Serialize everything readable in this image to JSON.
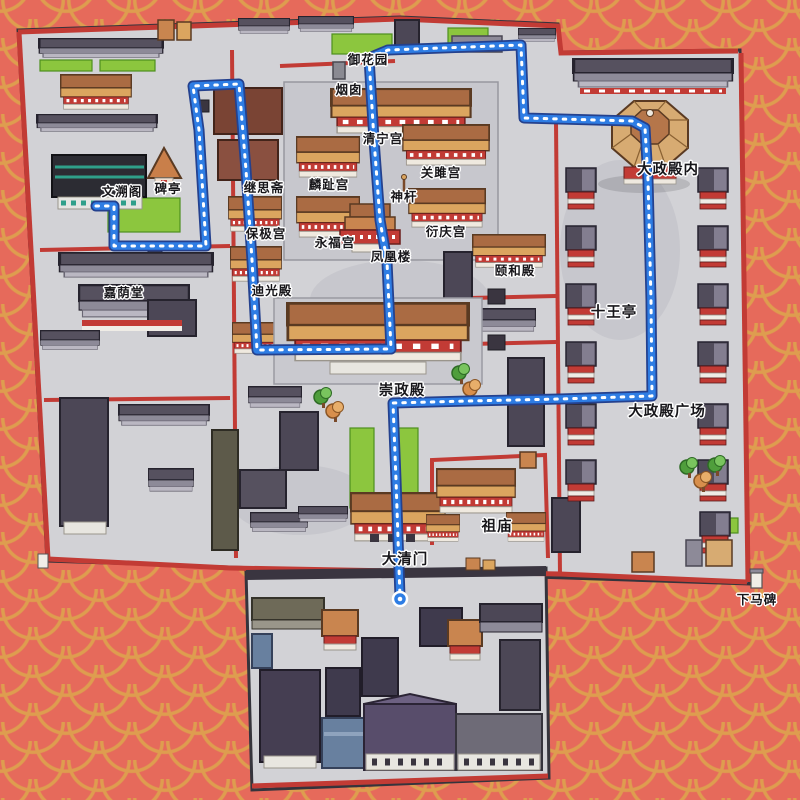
{
  "labels": [
    {
      "id": "yuhuayuan",
      "text": "御花园"
    },
    {
      "id": "yancong",
      "text": "烟囱"
    },
    {
      "id": "qingninggong",
      "text": "清宁宫"
    },
    {
      "id": "guanjugong",
      "text": "关雎宫"
    },
    {
      "id": "linzhigong",
      "text": "麟趾宫"
    },
    {
      "id": "shengan",
      "text": "神杆"
    },
    {
      "id": "yanqinggong",
      "text": "衍庆宫"
    },
    {
      "id": "yongfugong",
      "text": "永福宫"
    },
    {
      "id": "fenghuanglou",
      "text": "凤凰楼"
    },
    {
      "id": "yihedian",
      "text": "颐和殿"
    },
    {
      "id": "jisizhai",
      "text": "继思斋"
    },
    {
      "id": "baojigong",
      "text": "保极宫"
    },
    {
      "id": "diguangdian",
      "text": "迪光殿"
    },
    {
      "id": "wensuge",
      "text": "文溯阁"
    },
    {
      "id": "beiting",
      "text": "碑亭"
    },
    {
      "id": "jiayintang",
      "text": "嘉荫堂"
    },
    {
      "id": "chongzhengdian",
      "text": "崇政殿"
    },
    {
      "id": "shiwangting",
      "text": "十王亭"
    },
    {
      "id": "dazhengdiannei",
      "text": "大政殿内"
    },
    {
      "id": "dazhengdianguangchang",
      "text": "大政殿广场"
    },
    {
      "id": "zumiao",
      "text": "祖庙"
    },
    {
      "id": "daqingmen",
      "text": "大清门"
    },
    {
      "id": "xiamabei",
      "text": "下马碑"
    }
  ],
  "colors": {
    "background": "#e66a5b",
    "scale_pattern": "#de9d4f",
    "map_base": "#d2d2d6",
    "wall_red": "#c23b35",
    "roof_orange": "#c9854f",
    "roof_dark": "#514c5b",
    "lawn_green": "#8cc63e",
    "route_blue": "#2e7de4",
    "route_casing": "#24418e"
  }
}
